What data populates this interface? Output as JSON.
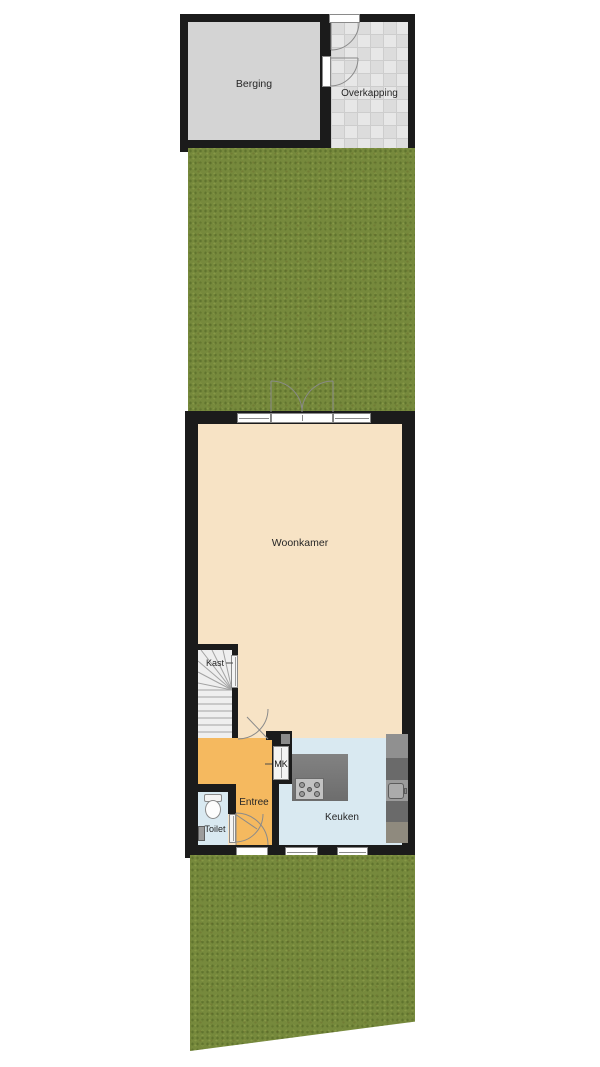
{
  "plan_type": "floorplan",
  "rooms": {
    "berging": {
      "label": "Berging"
    },
    "overkapping": {
      "label": "Overkapping"
    },
    "woonkamer": {
      "label": "Woonkamer"
    },
    "kast": {
      "label": "Kast"
    },
    "entree": {
      "label": "Entree"
    },
    "toilet": {
      "label": "Toilet"
    },
    "keuken": {
      "label": "Keuken"
    },
    "meterkast": {
      "label": "MK"
    }
  },
  "colors": {
    "wall": "#1b1b1b",
    "grass": "#76893c",
    "woonkamer_floor": "#f7e3c5",
    "entree_floor": "#f5b95f",
    "wet_room_floor": "#d9e9f1",
    "berging_floor": "#d4d4d4",
    "overkapping_tile": "#e3e3e3",
    "stair_floor": "#efefef",
    "counter_dark": "#6a6a6a",
    "counter_mid": "#909090",
    "counter_light": "#9b9b9b",
    "counter_taupe": "#8f8a7e",
    "island_gray": "#787878"
  }
}
